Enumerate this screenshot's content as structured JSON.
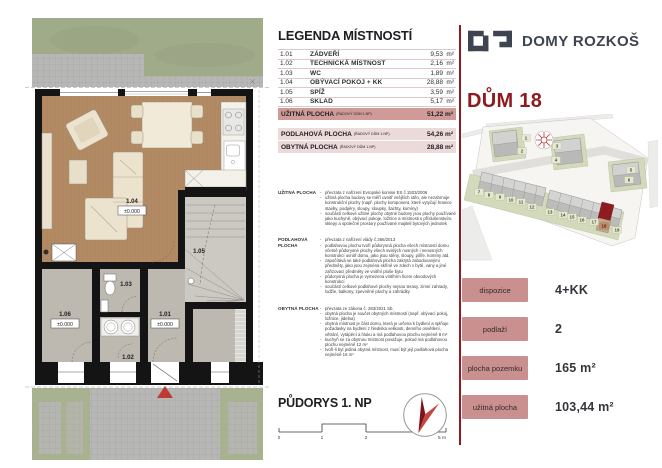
{
  "brand": {
    "name": "DOMY ROZKOŠ"
  },
  "house": {
    "title": "DŮM 18"
  },
  "legend": {
    "title": "LEGENDA MÍSTNOSTÍ",
    "rows": [
      {
        "code": "1.01",
        "name": "ZÁDVEŘÍ",
        "area": "9,53",
        "unit": "m²"
      },
      {
        "code": "1.02",
        "name": "TECHNICKÁ MÍSTNOST",
        "area": "2,16",
        "unit": "m²"
      },
      {
        "code": "1.03",
        "name": "WC",
        "area": "1,89",
        "unit": "m²"
      },
      {
        "code": "1.04",
        "name": "OBÝVACÍ POKOJ + KK",
        "area": "28,88",
        "unit": "m²"
      },
      {
        "code": "1.05",
        "name": "SPÍŽ",
        "area": "3,59",
        "unit": "m²"
      },
      {
        "code": "1.06",
        "name": "SKLAD",
        "area": "5,17",
        "unit": "m²"
      }
    ],
    "primary_total": {
      "label": "UŽITNÁ PLOCHA",
      "note": "(ŘADOVÝ DŮM 1.NP)",
      "value": "51,22 m²"
    },
    "secondary_totals": [
      {
        "label": "PODLAHOVÁ PLOCHA",
        "note": "(ŘADOVÝ DŮM 1.NP)",
        "value": "54,26 m²"
      },
      {
        "label": "OBYTNÁ PLOCHA",
        "note": "(ŘADOVÝ DŮM 1.NP)",
        "value": "28,88 m²"
      }
    ]
  },
  "definitions": [
    {
      "label": "UŽITNÁ PLOCHA",
      "bullets": [
        "převzata z nařízení Evropské komise ES č.1503/2006",
        "užitná plocha budovy se měří uvnitř vnějších stěn, ale nezahrnuje konstrukční plochy (např. plochy komponent, které vytyčují hranice stavby, podpěry, sloupy, sloupky, šachty, komíny)",
        "součástí celkové užitné plochy obytné budovy jsou plochy používané jako kuchyně, obývací pokoje, ložnice a místnosti s příslušenstvím, sklepy a společné prostory používané majiteli bytových jednotek"
      ]
    },
    {
      "label": "PODLAHOVÁ PLOCHA",
      "bullets": [
        "převzata z nařízení vlády č.366/2013",
        "podlahovou plochu tvoří půdorysná plocha všech místností domu včetně půdorysné plochy všech svislých nosných i nenosných konstrukcí uvnitř domu, jako jsou stěny, sloupy, pilíře, komíny atd.",
        "započítává se také podlahová plocha zakrytá zabudovanými předměty, jako jsou zejména skříně ve zdech v bytě, vany a jiné zařizovací předměty ve vnitřní ploše bytu",
        "půdorysná plocha je vymezena vnitřním lícem obvodových konstrukcí",
        "součástí celkové podlahové plochy nejsou terasy, zimní zahrady, lodžie, balkony, zpevněné plochy a zahrádky"
      ]
    },
    {
      "label": "OBYTNÁ PLOCHA",
      "bullets": [
        "převzata ze zákona č. 283/2021 Sb.",
        "obytná plocha je součet obytných místností (např. obývací pokoj, ložnice, jídelna)",
        "obytná místnost je část domu, která je určena k bydlení a splňuje požadavky na bydlení z hlediska velikosti, denního osvětlení, větrání, vytápění a hluku a má podlahovou plochu nejméně 8 m²",
        "kuchyň se za obytnou místnost považuje, pokud má podlahovou plochu nejméně 12 m²",
        "tvoří-li byt jediná obytná místnost, musí být její podlahová plocha nejméně 16 m²"
      ]
    }
  ],
  "plan": {
    "title": "PŮDORYS 1. NP",
    "scale_labels": [
      "0",
      "1",
      "2",
      "5 m"
    ],
    "rooms": [
      {
        "code": "1.04",
        "level": "±0.000"
      },
      {
        "code": "1.05"
      },
      {
        "code": "1.03"
      },
      {
        "code": "1.06",
        "level": "±0.000"
      },
      {
        "code": "1.01",
        "level": "±0.000"
      },
      {
        "code": "1.02"
      }
    ]
  },
  "site_plan": {
    "highlighted_lot": "18",
    "lots": [
      {
        "n": "1",
        "x": 64,
        "y": 24
      },
      {
        "n": "2",
        "x": 60,
        "y": 37
      },
      {
        "n": "3",
        "x": 95,
        "y": 32
      },
      {
        "n": "4",
        "x": 94,
        "y": 46
      },
      {
        "n": "5",
        "x": 169,
        "y": 56
      },
      {
        "n": "6",
        "x": 167,
        "y": 66
      },
      {
        "n": "7",
        "x": 17,
        "y": 78
      },
      {
        "n": "8",
        "x": 27,
        "y": 81
      },
      {
        "n": "9",
        "x": 38,
        "y": 83
      },
      {
        "n": "10",
        "x": 49,
        "y": 86
      },
      {
        "n": "11",
        "x": 59,
        "y": 88
      },
      {
        "n": "12",
        "x": 70,
        "y": 93
      },
      {
        "n": "13",
        "x": 88,
        "y": 98
      },
      {
        "n": "14",
        "x": 101,
        "y": 101
      },
      {
        "n": "15",
        "x": 110,
        "y": 103
      },
      {
        "n": "16",
        "x": 120,
        "y": 106
      },
      {
        "n": "17",
        "x": 132,
        "y": 108
      },
      {
        "n": "18",
        "x": 142,
        "y": 112
      },
      {
        "n": "19",
        "x": 155,
        "y": 116
      }
    ]
  },
  "specs": [
    {
      "label": "dispozice",
      "value": "4+KK"
    },
    {
      "label": "podlaží",
      "value": "2"
    },
    {
      "label": "plocha pozemku",
      "value": "165 m²"
    },
    {
      "label": "užitná plocha",
      "value": "103,44 m²"
    }
  ],
  "colors": {
    "accent": "#8e1b20",
    "chip": "#c9908f",
    "row_light": "#ecdada",
    "row_header": "#cf9a98",
    "logo": "#3e4550",
    "lawn": "#a0ab8a",
    "wood_floor": "#b28a64",
    "gray_floor": "#bdb8b0"
  }
}
